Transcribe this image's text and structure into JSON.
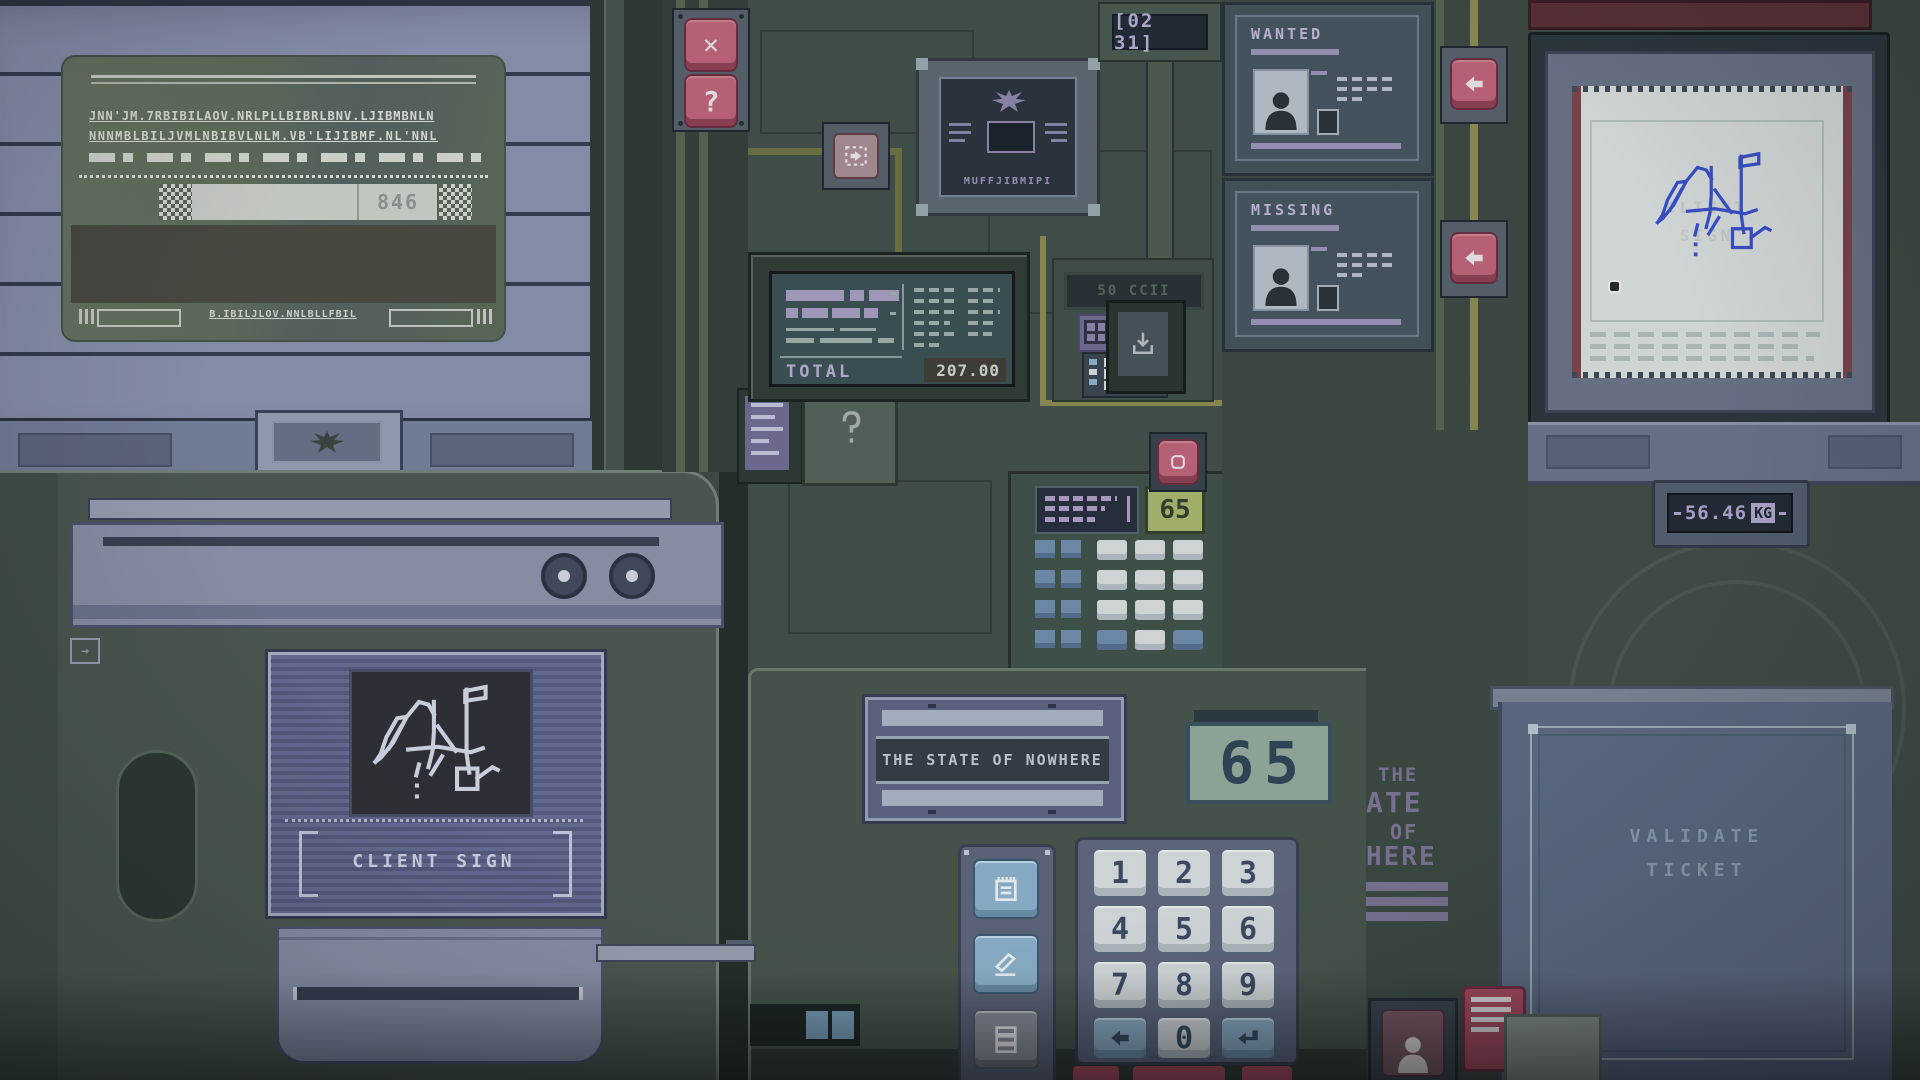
{
  "window": {
    "card": {
      "code": "846",
      "mrz_line1": "JNN'JM.7RBIBILAOV.NRLPLLBIBRLBNV.LJIBMBNLN",
      "mrz_line2": "NNNMBLBILJVMLNBIBVLNLM.VB'LIJIBMF.NL'NNL",
      "footer_text": "B.IBILJLOV.NNLBLLFBIL"
    }
  },
  "hud": {
    "clock": "[02 31]",
    "close_glyph": "✕",
    "help_glyph": "?"
  },
  "emblem_plaque": {
    "caption": "MUFFJIBMIPI"
  },
  "posters": {
    "wanted_title": "WANTED",
    "missing_title": "MISSING"
  },
  "monitor_paper": {
    "watermark_line1": "CLIENT",
    "watermark_line2": "SIGN"
  },
  "register": {
    "total_label": "TOTAL",
    "total_amount": "207.00"
  },
  "counter_module": {
    "display_value": "65",
    "faint_label": "50 CCII"
  },
  "scale": {
    "value": "56.46",
    "unit": "KG"
  },
  "imc_module": {
    "button_label": "IMC"
  },
  "sign_pad": {
    "label": "CLIENT SIGN"
  },
  "console": {
    "state_plaque_text": "THE STATE OF NOWHERE",
    "fee_display_value": "65",
    "keypad_keys": [
      "1",
      "2",
      "3",
      "4",
      "5",
      "6",
      "7",
      "8",
      "9",
      "0"
    ]
  },
  "wall_sign": {
    "visible_lines": [
      "THE",
      "ATE",
      "OF",
      "HERE"
    ]
  },
  "validator": {
    "label_line1": "VALIDATE",
    "label_line2": "TICKET"
  }
}
